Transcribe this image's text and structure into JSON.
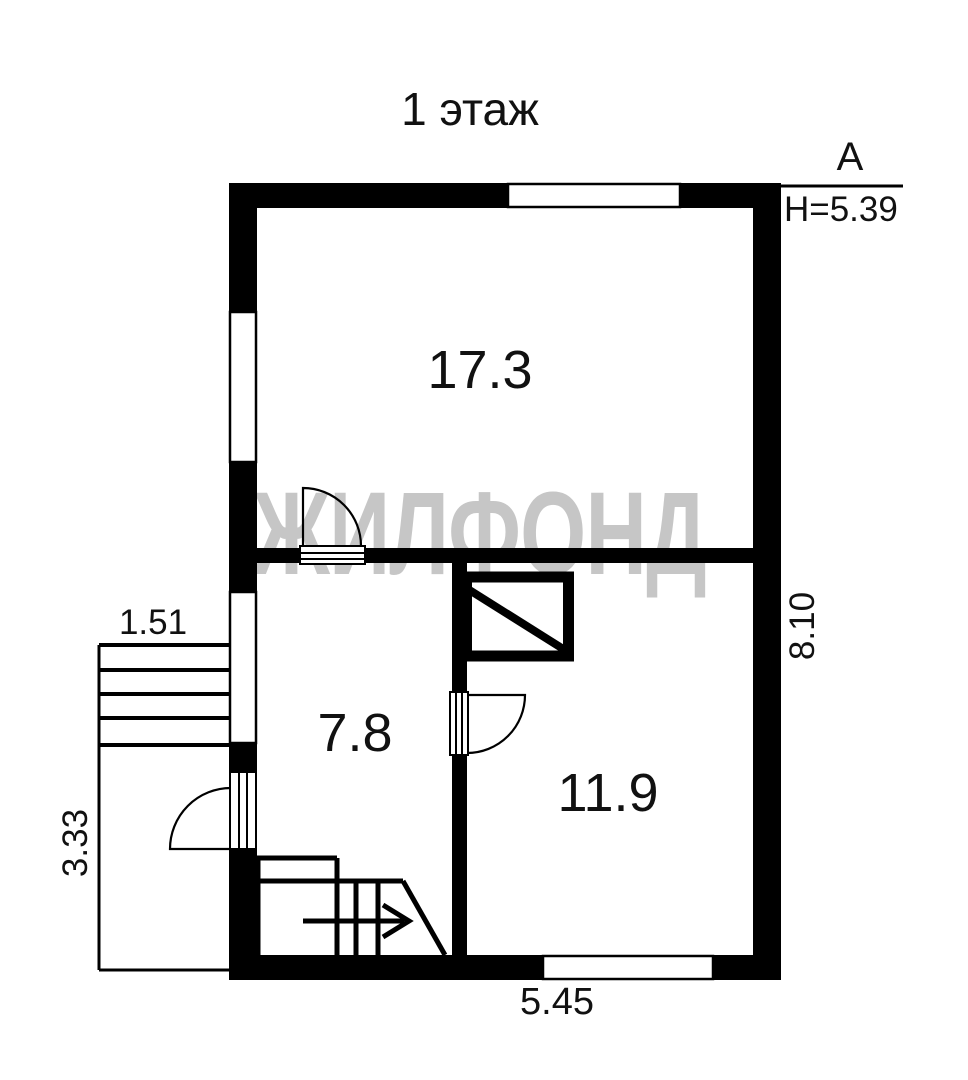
{
  "title": "1 этаж",
  "watermark": "ЖИЛФОНД",
  "colors": {
    "wall": "#000000",
    "line": "#111111",
    "watermark": "#c6c6c6",
    "background": "#ffffff"
  },
  "rooms": [
    {
      "name": "room-top",
      "area": "17.3"
    },
    {
      "name": "room-bottom-left",
      "area": "7.8"
    },
    {
      "name": "room-bottom-right",
      "area": "11.9"
    }
  ],
  "dimensions": {
    "bottom_width": "5.45",
    "right_height": "8.10",
    "porch_width": "1.51",
    "porch_depth": "3.33"
  },
  "axis": {
    "label": "А",
    "height_mark": "H=5.39"
  }
}
